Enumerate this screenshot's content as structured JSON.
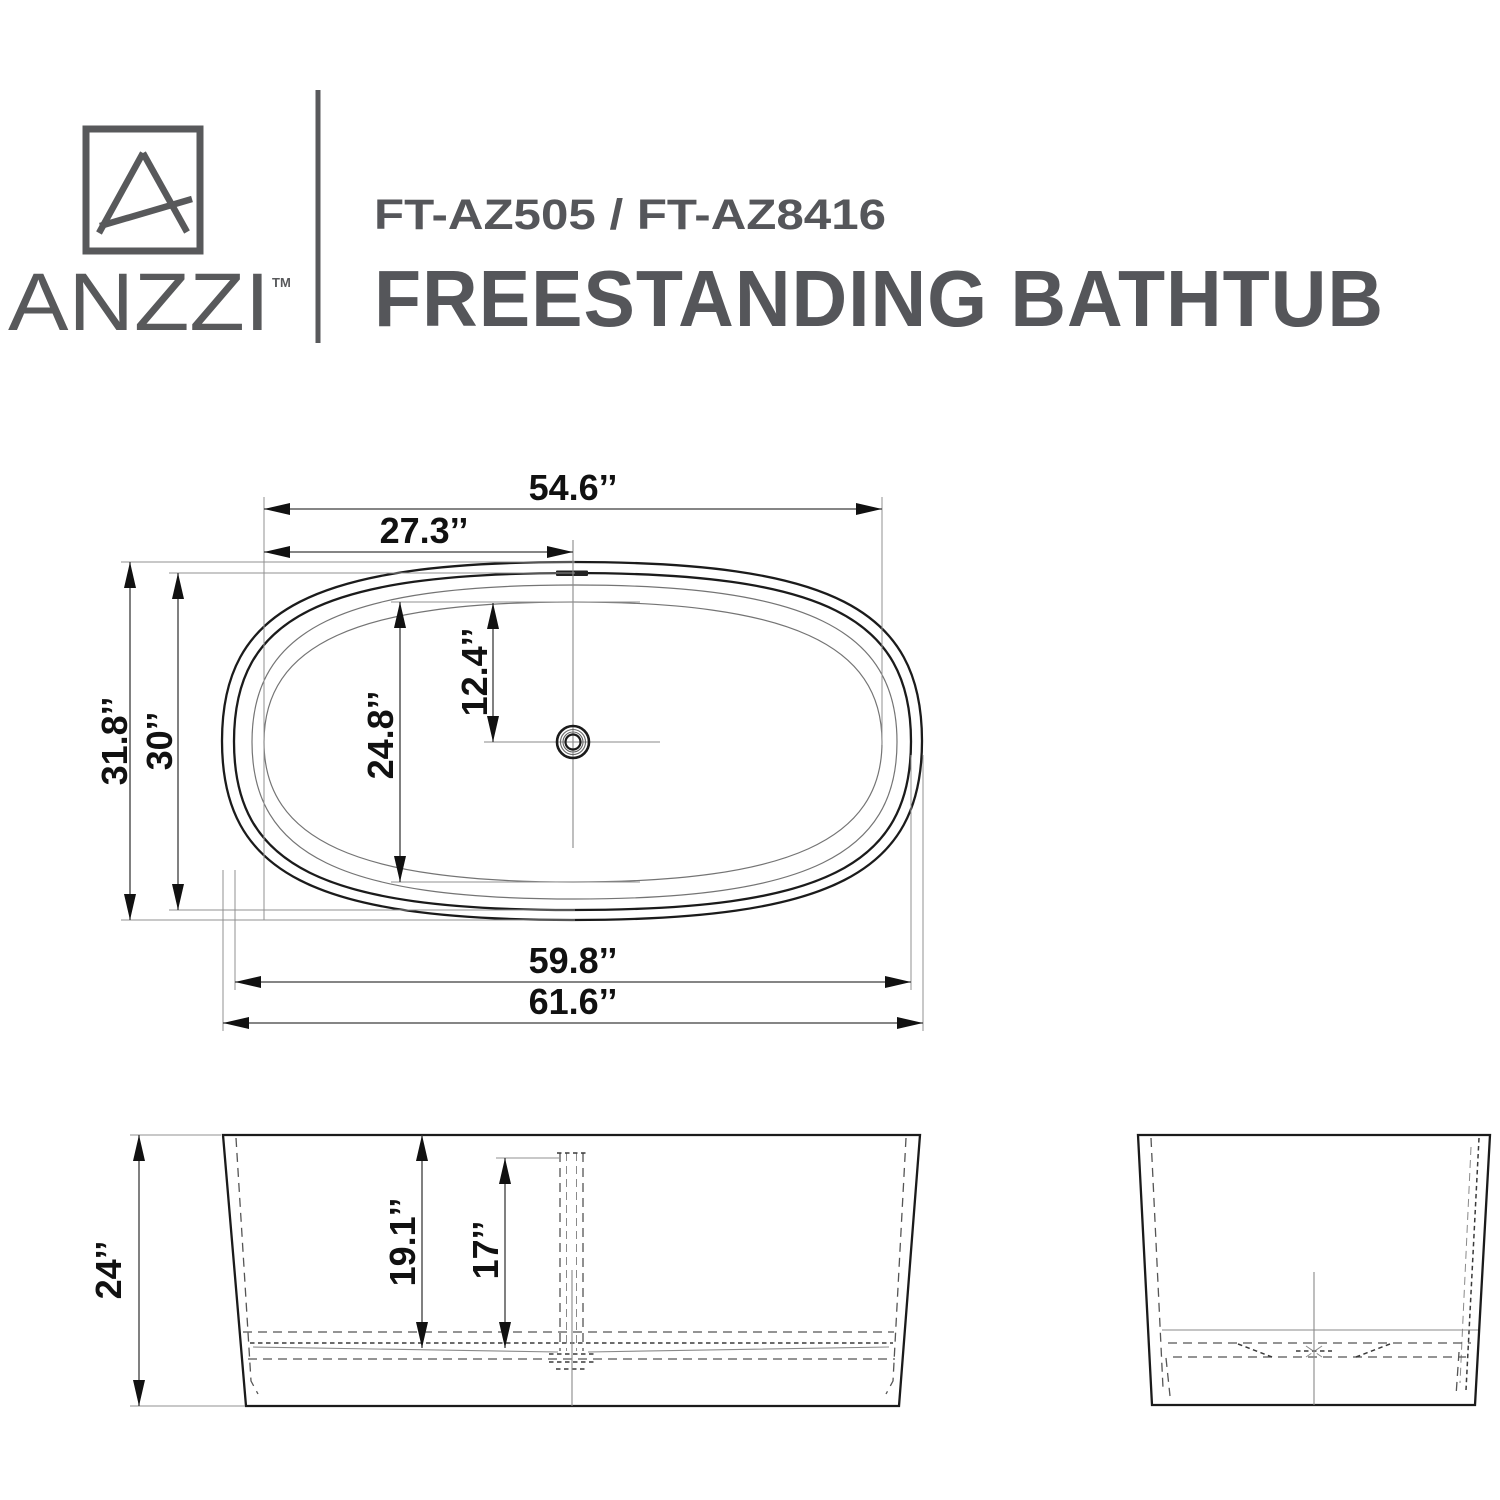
{
  "brand": {
    "logo_text": "ANZZI",
    "trademark": "TM"
  },
  "header": {
    "model": "FT-AZ505 / FT-AZ8416",
    "title": "FREESTANDING BATHTUB"
  },
  "colors": {
    "brand_gray": "#58595b",
    "ink": "#1b1b1b",
    "thin_line": "#747474",
    "extension_line": "#919191",
    "label": "#111111",
    "background": "#ffffff"
  },
  "top_view": {
    "name": "top-view",
    "dimensions": {
      "rim_length": "54.6’’",
      "drain_from_end": "27.3’’",
      "overall_width": "31.8’’",
      "rim_width": "30’’",
      "basin_width": "24.8’’",
      "drain_from_side": "12.4’’",
      "base_length": "59.8’’",
      "overall_length": "61.6’’"
    }
  },
  "side_view": {
    "name": "side-view",
    "dimensions": {
      "overall_height": "24’’",
      "interior_depth": "19.1’’",
      "overflow_height": "17’’"
    }
  },
  "end_view": {
    "name": "end-view"
  }
}
